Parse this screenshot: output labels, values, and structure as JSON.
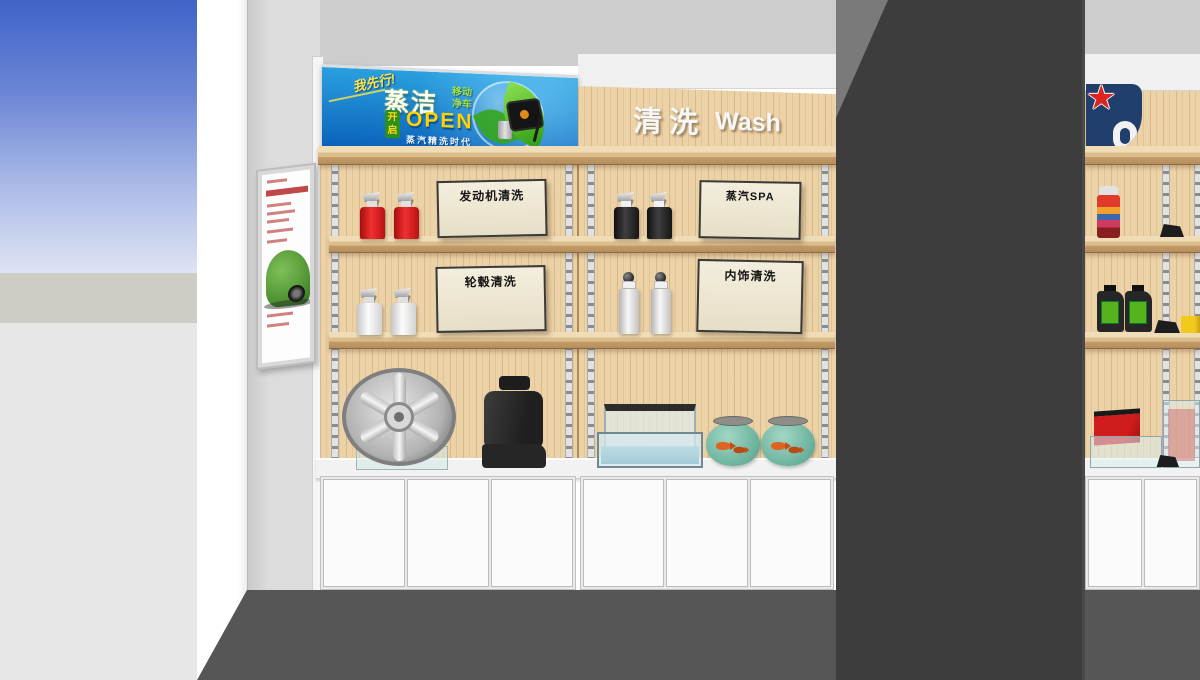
{
  "banner": {
    "slogan_script": "我先行!",
    "brand": "蒸洁",
    "sub1": "移动",
    "sub2": "净车",
    "badge": "开启",
    "open": "OPEN",
    "tagline": "蒸汽精洗时代"
  },
  "section_header": {
    "cn": "清洗",
    "en": "Wash"
  },
  "shelf_signs": {
    "engine": "发动机清洗",
    "steam_spa": "蒸汽SPA",
    "wheel": "轮毂清洗",
    "interior": "内饰清洗"
  },
  "palette": {
    "sky_blue": "#3f63c8",
    "banner_blue_top": "#2aa0e0",
    "banner_blue_bottom": "#0a60b8",
    "open_yellow": "#ffd200",
    "leaf_green": "#4db82a",
    "wood_panel": "#ecd2a7",
    "shelf_wood": "#dcbd8d",
    "column_gray": "#3d3d3d",
    "floor_gray": "#565656",
    "logo_navy": "#203f6d",
    "star_red": "#de2420",
    "bottle_red": "#e01818",
    "bottle_black": "#1f1f1f",
    "jug_label_green": "#56b31c",
    "fishbowl_teal": "#6bb39e",
    "cabinet_white": "#fbfbfb"
  }
}
